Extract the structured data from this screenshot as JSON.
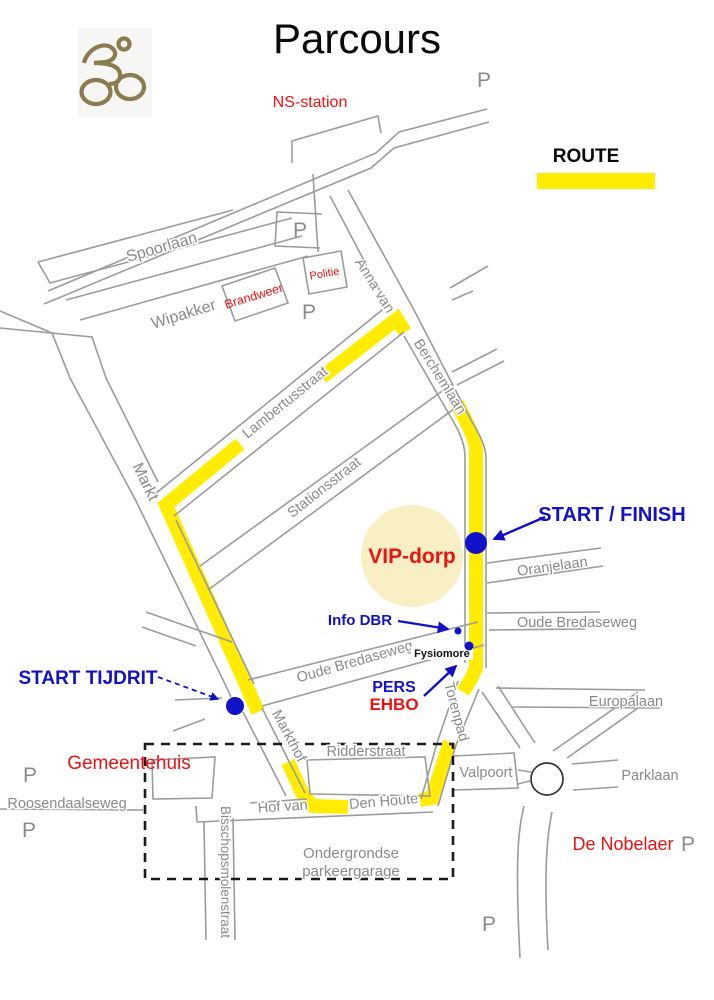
{
  "title": "Parcours",
  "legend": {
    "label": "ROUTE"
  },
  "markers": {
    "start_finish": "START / FINISH",
    "start_tijdrit": "START TIJDRIT",
    "info_dbr": "Info DBR",
    "pers": "PERS",
    "ehbo": "EHBO",
    "vip_dorp": "VIP-dorp",
    "fysiomore": "Fysiomore",
    "parking": "P"
  },
  "places": {
    "ns_station": "NS-station",
    "politie": "Politie",
    "brandweer": "Brandweer",
    "gemeentehuis": "Gemeentehuis",
    "de_nobelaer": "De Nobelaer",
    "valpoort": "Valpoort",
    "parking_garage_line1": "Ondergrondse",
    "parking_garage_line2": "parkeergarage"
  },
  "streets": {
    "spoorlaan": "Spoorlaan",
    "wipakker": "Wipakker",
    "lambertusstraat": "Lambertusstraat",
    "stationsstraat": "Stationsstraat",
    "markt": "Markt",
    "anna_van": "Anna van",
    "berchemlaan": "Berchemlaan",
    "oranjelaan": "Oranjelaan",
    "oude_bredaseweg": "Oude Bredaseweg",
    "europalaan": "Europalaan",
    "torenpad": "Torenpad",
    "ridderstraat": "Ridderstraat",
    "markthof": "Markthof",
    "hof_van": "Hof van",
    "den_houte": "Den Houte",
    "parklaan": "Parklaan",
    "roosendaalseweg": "Roosendaalseweg",
    "bisschopsmolenstraat": "Bisschopsmolenstraat"
  },
  "colors": {
    "route_yellow": "#FFEC00",
    "marker_blue": "#1111C8",
    "label_red": "#EE1111",
    "road_gray": "#9B9B9B",
    "label_gray": "#8A8A8A",
    "vip_fill": "#F8EFC4",
    "bike_brown": "#8D7B50"
  }
}
